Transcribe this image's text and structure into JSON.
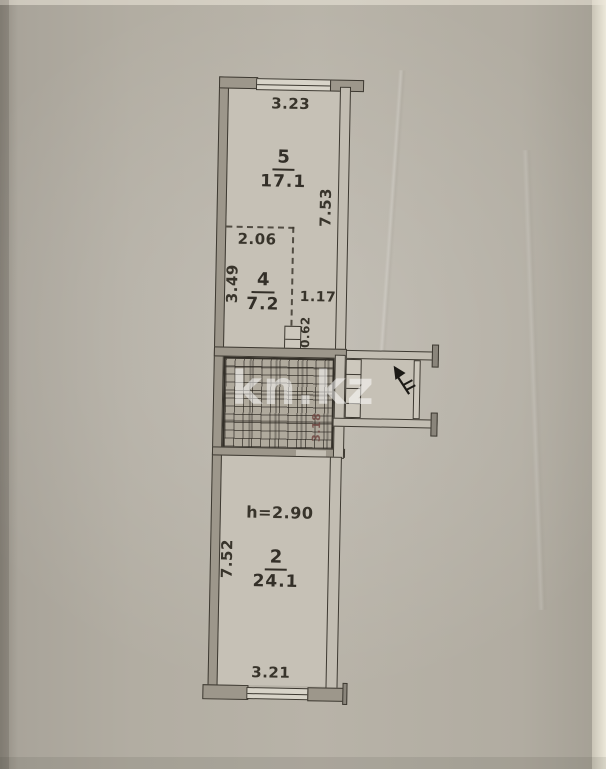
{
  "document": {
    "kind": "apartment floor plan scan",
    "watermark": "kn.kz",
    "rooms": [
      {
        "number": "5",
        "area": "17.1"
      },
      {
        "number": "4",
        "area": "7.2"
      },
      {
        "number": "2",
        "area": "24.1"
      }
    ],
    "dimensions": {
      "top_width": "3.23",
      "right_height": "7.53",
      "room4_width": "2.06",
      "room4_height": "3.49",
      "corridor_width": "1.17",
      "duct_width": "0.62",
      "stair_mark": "3.18",
      "ceiling_height": "h=2.90",
      "room2_height": "7.52",
      "bottom_width": "3.21"
    },
    "icons": {
      "entry_arrow": "entry-direction-arrow"
    },
    "colors": {
      "paper": "#b3aea3",
      "ink": "#3d3931",
      "wall_fill": "#9d978b",
      "hatch_fill": "#b0aa9d",
      "watermark": "rgba(255,255,255,0.52)",
      "stamp_red": "#6e443f"
    }
  }
}
